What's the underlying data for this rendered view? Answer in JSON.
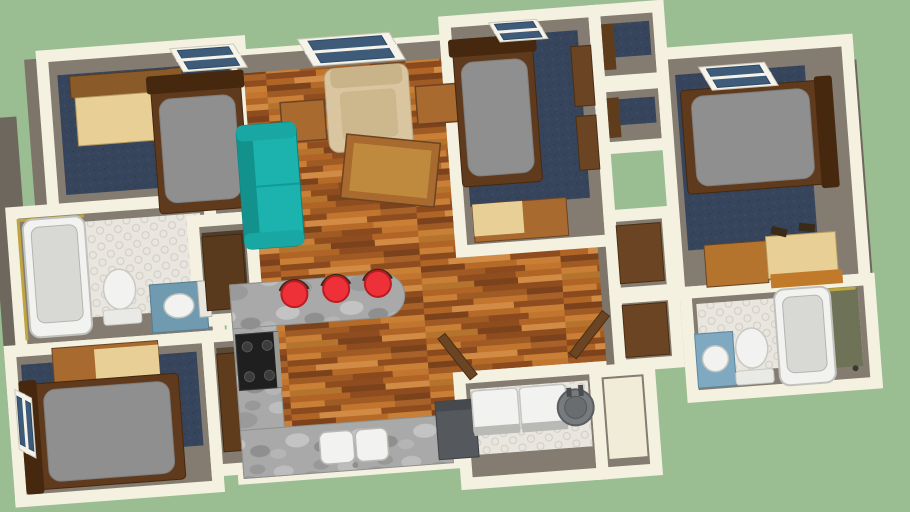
{
  "meta": {
    "application": "3d-floor-plan-viewer",
    "description": "Top-down 3D rendered floor plan of an apartment on a green viewport background",
    "visible_text": []
  },
  "canvas": {
    "width": 910,
    "height": 512,
    "background": "#9abd92",
    "rotation_deg": -4.3,
    "rotation_center": [
      455,
      256
    ]
  },
  "palette": {
    "bg": "#9abd92",
    "wall": "#f4f1e1",
    "face": "#847c70",
    "faceMid": "#7d7569",
    "faceDark": "#6e675d",
    "carpet": "#36455c",
    "teal": "#1cb3ae",
    "tealDark": "#12918d",
    "beige": "#d9c6a0",
    "beigeDark": "#c9b489",
    "red": "#ee3038",
    "white": "#f2f2f0",
    "whiteDim": "#d8d8d4",
    "steel": "#55585c",
    "woodFurn": "#a86a2e",
    "woodLight": "#e8cf96",
    "woodMid": "#8a5a28",
    "frameDark": "#5f3a1d",
    "frameDarker": "#46280f",
    "doorBrown": "#6b4423",
    "mattress": "#8f8f8f",
    "glass": "#3e5c7a",
    "gold": "#bfa53f",
    "olive": "#6e7257",
    "vanityBlue": "#6f9ab0",
    "vanityBlue2": "#7fa9c0",
    "black": "#1f1f1f",
    "heater": "#787b7e",
    "heaterDark": "#5a5d60",
    "ctrl": "#b9b9b6"
  },
  "scene": [
    {
      "t": "rect",
      "name": "west-wall-face",
      "x": -2,
      "y": 84,
      "w": 30,
      "h": 380,
      "f": "faceDark"
    },
    {
      "t": "rect",
      "name": "left-jog-wall-face",
      "x": 40,
      "y": 28,
      "w": 30,
      "h": 162,
      "f": "faceMid"
    },
    {
      "t": "rect",
      "name": "right-wall-face",
      "x": 852,
      "y": 90,
      "w": 18,
      "h": 320,
      "f": "faceDark"
    },
    {
      "t": "room",
      "name": "bedroom-top-left",
      "x": 58,
      "y": 26,
      "w": 198,
      "h": 176,
      "floor": "carpet",
      "in": [
        20,
        12,
        36,
        14
      ]
    },
    {
      "t": "path",
      "name": "main-wood-floor",
      "d": "M252,40 L462,40 L462,230 L612,230 L612,378 L462,378 L462,462 L228,462 L228,268 L252,268 Z",
      "f": "wood",
      "s": "wall",
      "sw": 12
    },
    {
      "t": "rect",
      "name": "living-north-wall-face",
      "x": 252,
      "y": 40,
      "w": 210,
      "h": 18,
      "f": "face"
    },
    {
      "t": "rect",
      "name": "hall-east-wall-face",
      "x": 598,
      "y": 230,
      "w": 14,
      "h": 148,
      "f": "faceMid"
    },
    {
      "t": "room",
      "name": "bedroom-middle",
      "x": 462,
      "y": 22,
      "w": 150,
      "h": 230,
      "floor": "carpet",
      "in": [
        18,
        18,
        44,
        12
      ]
    },
    {
      "t": "room",
      "name": "closet-a",
      "x": 612,
      "y": 22,
      "w": 64,
      "h": 72,
      "floor": "carpet",
      "in": [
        14,
        10,
        24,
        8
      ]
    },
    {
      "t": "room",
      "name": "closet-b",
      "x": 612,
      "y": 98,
      "w": 64,
      "h": 62,
      "floor": "carpet",
      "in": [
        14,
        10,
        22,
        8
      ]
    },
    {
      "t": "room",
      "name": "bedroom-right",
      "x": 676,
      "y": 70,
      "w": 186,
      "h": 240,
      "floor": "carpet",
      "in": [
        22,
        44,
        42,
        12
      ]
    },
    {
      "t": "room",
      "name": "bathroom-left",
      "x": 16,
      "y": 180,
      "w": 198,
      "h": 138,
      "floor": "hex",
      "in": [
        14,
        10,
        28,
        10
      ]
    },
    {
      "t": "room",
      "name": "pantry",
      "x": 196,
      "y": 202,
      "w": 58,
      "h": 100,
      "floor": "#4e3d2c",
      "in": [
        12,
        8,
        20,
        8
      ]
    },
    {
      "t": "room",
      "name": "bedroom-bottom-left",
      "x": 4,
      "y": 318,
      "w": 198,
      "h": 150,
      "floor": "carpet",
      "in": [
        14,
        12,
        42,
        10
      ]
    },
    {
      "t": "room",
      "name": "closet-bottom",
      "x": 202,
      "y": 318,
      "w": 54,
      "h": 134,
      "floor": "#5a4936",
      "in": [
        12,
        8,
        28,
        8
      ]
    },
    {
      "t": "room",
      "name": "hall-closet-a",
      "x": 612,
      "y": 228,
      "w": 58,
      "h": 78,
      "floor": "faceMid",
      "in": [
        10,
        8,
        16,
        8
      ]
    },
    {
      "t": "room",
      "name": "hall-closet-b",
      "x": 612,
      "y": 310,
      "w": 58,
      "h": 68,
      "floor": "faceMid",
      "in": [
        10,
        8,
        16,
        8
      ]
    },
    {
      "t": "room",
      "name": "bathroom-right",
      "x": 682,
      "y": 310,
      "w": 184,
      "h": 104,
      "floor": "hex",
      "in": [
        12,
        12,
        22,
        10
      ]
    },
    {
      "t": "room",
      "name": "laundry-room",
      "x": 450,
      "y": 378,
      "w": 136,
      "h": 106,
      "floor": "hex",
      "in": [
        12,
        8,
        28,
        10
      ]
    },
    {
      "t": "room",
      "name": "utility-extension",
      "x": 586,
      "y": 382,
      "w": 54,
      "h": 102,
      "floor": "#f0ecd8",
      "in": [
        8,
        8,
        14,
        8
      ]
    },
    {
      "t": "rect",
      "name": "desk-hutch",
      "x": 84,
      "y": 48,
      "w": 110,
      "h": 22,
      "f": "woodMid",
      "s": "frameDark",
      "sw": 1
    },
    {
      "t": "rect",
      "name": "desk-surface",
      "x": 88,
      "y": 70,
      "w": 104,
      "h": 48,
      "f": "woodLight",
      "s": "#b99a5e",
      "sw": 1
    },
    {
      "t": "rect",
      "name": "desk-side-panel",
      "x": 182,
      "y": 48,
      "w": 14,
      "h": 70,
      "f": "woodMid"
    },
    {
      "t": "bed",
      "name": "bed-top-left",
      "x": 164,
      "y": 62,
      "w": 90,
      "h": 130,
      "head": "top"
    },
    {
      "t": "rect",
      "name": "armchair",
      "x": 338,
      "y": 60,
      "w": 84,
      "h": 84,
      "rx": 10,
      "f": "beige",
      "s": "#b8a57e",
      "sw": 1
    },
    {
      "t": "rect",
      "name": "armchair-back",
      "x": 344,
      "y": 60,
      "w": 72,
      "h": 20,
      "rx": 6,
      "f": "beigeDark"
    },
    {
      "t": "rect",
      "name": "armchair-seat",
      "x": 352,
      "y": 84,
      "w": 56,
      "h": 48,
      "rx": 5,
      "f": "#cdb78d"
    },
    {
      "t": "rect",
      "name": "end-table-left",
      "x": 292,
      "y": 90,
      "w": 44,
      "h": 40,
      "f": "woodFurn",
      "s": "#6b4423",
      "sw": 1.5
    },
    {
      "t": "rect",
      "name": "end-table-right",
      "x": 428,
      "y": 84,
      "w": 42,
      "h": 38,
      "f": "woodFurn",
      "s": "#6b4423",
      "sw": 1.5
    },
    {
      "t": "rect",
      "name": "coffee-table",
      "x": 350,
      "y": 134,
      "w": 94,
      "h": 64,
      "rot": 10,
      "f": "woodFurn",
      "s": "#6b4423",
      "sw": 1.5
    },
    {
      "t": "rect",
      "name": "coffee-table-top",
      "x": 358,
      "y": 142,
      "w": 78,
      "h": 48,
      "rot": 10,
      "f": "#c08a3e"
    },
    {
      "t": "rect",
      "name": "sofa",
      "x": 246,
      "y": 110,
      "w": 60,
      "h": 124,
      "rx": 8,
      "f": "teal",
      "s": "#0e7f7c",
      "sw": 1
    },
    {
      "t": "rect",
      "name": "sofa-back",
      "x": 246,
      "y": 110,
      "w": 16,
      "h": 124,
      "rx": 6,
      "f": "tealDark"
    },
    {
      "t": "rect",
      "name": "sofa-arm",
      "x": 246,
      "y": 110,
      "w": 60,
      "h": 16,
      "rx": 6,
      "f": "#18a7a2"
    },
    {
      "t": "rect",
      "name": "sofa-arm",
      "x": 246,
      "y": 218,
      "w": 60,
      "h": 16,
      "rx": 6,
      "f": "#18a7a2"
    },
    {
      "t": "line",
      "name": "sofa-cushion-seam",
      "x1": 262,
      "y1": 172,
      "x2": 306,
      "y2": 172,
      "s": "#129a96",
      "sw": 2
    },
    {
      "t": "bed",
      "name": "bed-middle",
      "x": 468,
      "y": 48,
      "w": 80,
      "h": 140,
      "head": "top"
    },
    {
      "t": "rect",
      "name": "closet-door",
      "x": 586,
      "y": 56,
      "w": 20,
      "h": 60,
      "f": "doorBrown",
      "s": "#4a2f12",
      "sw": 1
    },
    {
      "t": "rect",
      "name": "closet-door",
      "x": 586,
      "y": 126,
      "w": 20,
      "h": 54,
      "f": "doorBrown",
      "s": "#4a2f12",
      "sw": 1
    },
    {
      "t": "rect",
      "name": "desk",
      "x": 476,
      "y": 206,
      "w": 94,
      "h": 38,
      "f": "woodFurn",
      "s": "#6b4423",
      "sw": 1
    },
    {
      "t": "rect",
      "name": "desk-top",
      "x": 476,
      "y": 206,
      "w": 50,
      "h": 32,
      "f": "woodLight"
    },
    {
      "t": "rect",
      "name": "closet-door",
      "x": 618,
      "y": 36,
      "w": 12,
      "h": 46,
      "f": "#5f3c1c"
    },
    {
      "t": "rect",
      "name": "closet-door",
      "x": 618,
      "y": 110,
      "w": 12,
      "h": 40,
      "f": "#5f3c1c"
    },
    {
      "t": "bed",
      "name": "bed-right",
      "x": 692,
      "y": 108,
      "w": 144,
      "h": 104,
      "head": "right"
    },
    {
      "t": "rect",
      "name": "desk",
      "x": 704,
      "y": 264,
      "w": 62,
      "h": 42,
      "f": "#b5742e",
      "s": "#6b4423",
      "sw": 1
    },
    {
      "t": "rect",
      "name": "desk-top",
      "x": 766,
      "y": 260,
      "w": 70,
      "h": 42,
      "f": "woodLight",
      "s": "#b99a5e",
      "sw": 1
    },
    {
      "t": "rect",
      "name": "desk-shelf",
      "x": 768,
      "y": 298,
      "w": 72,
      "h": 14,
      "f": "#c07a2a"
    },
    {
      "t": "rect",
      "name": "shoe",
      "x": 772,
      "y": 252,
      "w": 16,
      "h": 8,
      "rot": 18,
      "f": "#3a2a18"
    },
    {
      "t": "rect",
      "name": "shoe",
      "x": 800,
      "y": 250,
      "w": 16,
      "h": 8,
      "rot": 10,
      "f": "#3a2a18"
    },
    {
      "t": "path",
      "name": "shower-trim",
      "d": "M22,308 L22,188 L88,188",
      "f": "none",
      "s": "gold",
      "sw": 3
    },
    {
      "t": "rect",
      "name": "bathtub",
      "x": 26,
      "y": 188,
      "w": 62,
      "h": 118,
      "rx": 10,
      "f": "white",
      "s": "#c2c2bd",
      "sw": 2
    },
    {
      "t": "rect",
      "name": "bathtub-inner",
      "x": 34,
      "y": 196,
      "w": 46,
      "h": 96,
      "rx": 8,
      "f": "whiteDim",
      "s": "#b5b5b0",
      "sw": 1
    },
    {
      "t": "ellipse",
      "name": "toilet-bowl",
      "cx": 118,
      "cy": 264,
      "rx": 16,
      "ry": 20,
      "f": "white",
      "s": "#c9c9c4",
      "sw": 1.5
    },
    {
      "t": "rect",
      "name": "toilet-tank",
      "x": 100,
      "y": 284,
      "w": 38,
      "h": 15,
      "rx": 3,
      "f": "#e9e9e6",
      "s": "#c9c9c4",
      "sw": 1
    },
    {
      "t": "rect",
      "name": "bathroom-vanity",
      "x": 148,
      "y": 262,
      "w": 56,
      "h": 48,
      "f": "vanityBlue",
      "s": "#557e92",
      "sw": 1
    },
    {
      "t": "ellipse",
      "name": "sink",
      "cx": 176,
      "cy": 285,
      "rx": 15,
      "ry": 12,
      "f": "white",
      "s": "#c2c2bd",
      "sw": 1.5
    },
    {
      "t": "rect",
      "name": "mirror",
      "x": 196,
      "y": 262,
      "w": 12,
      "h": 36,
      "f": "#e8e6de",
      "s": "#b5b3a8",
      "sw": 1
    },
    {
      "t": "rect",
      "name": "desk",
      "x": 46,
      "y": 318,
      "w": 106,
      "h": 38,
      "f": "woodFurn",
      "s": "#6b4423",
      "sw": 1
    },
    {
      "t": "rect",
      "name": "desk-top",
      "x": 88,
      "y": 322,
      "w": 64,
      "h": 32,
      "f": "woodLight"
    },
    {
      "t": "rect",
      "name": "desk-chair",
      "x": 96,
      "y": 352,
      "w": 34,
      "h": 14,
      "f": "#b5742e"
    },
    {
      "t": "bed",
      "name": "bed-bottom-left",
      "x": 18,
      "y": 352,
      "w": 152,
      "h": 106,
      "head": "left"
    },
    {
      "t": "rect",
      "name": "closet-door",
      "x": 210,
      "y": 336,
      "w": 38,
      "h": 98,
      "f": "#5f3c1c",
      "s": "#3e2812",
      "sw": 1
    },
    {
      "t": "rect",
      "name": "pantry-door",
      "x": 204,
      "y": 218,
      "w": 40,
      "h": 74,
      "f": "#5a3a1c",
      "s": "#3e2812",
      "sw": 1
    },
    {
      "t": "rect",
      "name": "kitchen-counter-left",
      "x": 228,
      "y": 268,
      "w": 44,
      "h": 194,
      "f": "marble",
      "s": "#8f8f8a",
      "sw": 1
    },
    {
      "t": "path",
      "name": "kitchen-counter-peninsula",
      "d": "M228,268 L380,268 A22,22 0 0 1 380,312 L228,312 Z",
      "f": "marble",
      "s": "#8f8f8a",
      "sw": 1
    },
    {
      "t": "rect",
      "name": "kitchen-counter-bottom",
      "x": 228,
      "y": 414,
      "w": 210,
      "h": 48,
      "f": "marble",
      "s": "#8f8f8a",
      "sw": 1
    },
    {
      "t": "rect",
      "name": "stove",
      "x": 230,
      "y": 318,
      "w": 42,
      "h": 56,
      "f": "black",
      "s": "#3a3a3a",
      "sw": 1
    },
    {
      "t": "circle",
      "name": "burner",
      "cx": 241,
      "cy": 331,
      "r": 5,
      "f": "#3c3c3c",
      "s": "#565656",
      "sw": 1
    },
    {
      "t": "circle",
      "name": "burner",
      "cx": 261,
      "cy": 331,
      "r": 5,
      "f": "#3c3c3c",
      "s": "#565656",
      "sw": 1
    },
    {
      "t": "circle",
      "name": "burner",
      "cx": 241,
      "cy": 361,
      "r": 5,
      "f": "#3c3c3c",
      "s": "#565656",
      "sw": 1
    },
    {
      "t": "circle",
      "name": "burner",
      "cx": 261,
      "cy": 361,
      "r": 5,
      "f": "#3c3c3c",
      "s": "#565656",
      "sw": 1
    },
    {
      "t": "rect",
      "name": "stove-trim",
      "x": 268,
      "y": 318,
      "w": 5,
      "h": 56,
      "f": "#9a9a95"
    },
    {
      "t": "rect",
      "name": "sink-basin",
      "x": 306,
      "y": 422,
      "w": 34,
      "h": 32,
      "rx": 7,
      "f": "white",
      "s": "#b9b9b4",
      "sw": 1.5
    },
    {
      "t": "rect",
      "name": "sink-basin",
      "x": 342,
      "y": 422,
      "w": 32,
      "h": 32,
      "rx": 7,
      "f": "white",
      "s": "#b9b9b4",
      "sw": 1.5
    },
    {
      "t": "circle",
      "name": "faucet",
      "cx": 340,
      "cy": 457,
      "r": 3,
      "f": "#8f8f8a"
    },
    {
      "t": "rect",
      "name": "appliance-counter",
      "x": 424,
      "y": 400,
      "w": 40,
      "h": 58,
      "f": "steel",
      "s": "#3e4144",
      "sw": 1
    },
    {
      "t": "rect",
      "name": "appliance-counter-top",
      "x": 424,
      "y": 400,
      "w": 40,
      "h": 10,
      "f": "#464a4e"
    },
    {
      "t": "stool",
      "name": "bar-stool",
      "cx": 292,
      "cy": 282
    },
    {
      "t": "stool",
      "name": "bar-stool",
      "cx": 334,
      "cy": 280
    },
    {
      "t": "stool",
      "name": "bar-stool",
      "cx": 376,
      "cy": 278
    },
    {
      "t": "rect",
      "name": "closet-door",
      "x": 618,
      "y": 238,
      "w": 44,
      "h": 58,
      "f": "doorBrown",
      "s": "#4a2f12",
      "sw": 1
    },
    {
      "t": "rect",
      "name": "closet-door",
      "x": 618,
      "y": 318,
      "w": 44,
      "h": 52,
      "f": "doorBrown",
      "s": "#4a2f12",
      "sw": 1
    },
    {
      "t": "rect",
      "name": "shower-floor",
      "x": 824,
      "y": 318,
      "w": 30,
      "h": 78,
      "f": "olive"
    },
    {
      "t": "path",
      "name": "shower-trim",
      "d": "M824,396 L824,318 L852,318",
      "f": "none",
      "s": "gold",
      "sw": 3
    },
    {
      "t": "rect",
      "name": "bathroom-vanity",
      "x": 688,
      "y": 352,
      "w": 38,
      "h": 54,
      "f": "vanityBlue2",
      "s": "#5d87a0",
      "sw": 1
    },
    {
      "t": "circle",
      "name": "sink",
      "cx": 707,
      "cy": 378,
      "r": 13,
      "f": "white",
      "s": "#c2c2bd",
      "sw": 1.5
    },
    {
      "t": "ellipse",
      "name": "toilet-bowl",
      "cx": 744,
      "cy": 370,
      "rx": 16,
      "ry": 20,
      "f": "white",
      "s": "#c9c9c4",
      "sw": 1.5
    },
    {
      "t": "rect",
      "name": "toilet-tank",
      "x": 726,
      "y": 392,
      "w": 38,
      "h": 14,
      "rx": 3,
      "f": "#e9e9e6",
      "s": "#c9c9c4",
      "sw": 1
    },
    {
      "t": "rect",
      "name": "bathtub",
      "x": 770,
      "y": 314,
      "w": 56,
      "h": 96,
      "rx": 10,
      "f": "white",
      "s": "#c2c2bd",
      "sw": 2
    },
    {
      "t": "rect",
      "name": "bathtub-inner",
      "x": 778,
      "y": 322,
      "w": 40,
      "h": 76,
      "rx": 8,
      "f": "whiteDim",
      "s": "#b5b5b0",
      "sw": 1
    },
    {
      "t": "circle",
      "name": "tub-faucet",
      "cx": 846,
      "cy": 398,
      "r": 3,
      "f": "#3a3a33"
    },
    {
      "t": "rect",
      "name": "washer",
      "x": 461,
      "y": 392,
      "w": 46,
      "h": 44,
      "rx": 4,
      "f": "white",
      "s": "#c6c6c2",
      "sw": 1.5
    },
    {
      "t": "rect",
      "name": "washer-panel",
      "x": 461,
      "y": 428,
      "w": 46,
      "h": 9,
      "f": "ctrl"
    },
    {
      "t": "rect",
      "name": "dryer",
      "x": 509,
      "y": 392,
      "w": 46,
      "h": 44,
      "rx": 4,
      "f": "white",
      "s": "#c6c6c2",
      "sw": 1.5
    },
    {
      "t": "rect",
      "name": "dryer-panel",
      "x": 509,
      "y": 428,
      "w": 46,
      "h": 9,
      "f": "ctrl"
    },
    {
      "t": "circle",
      "name": "water-heater",
      "cx": 564,
      "cy": 416,
      "r": 18,
      "f": "heater",
      "s": "heaterDark",
      "sw": 2
    },
    {
      "t": "circle",
      "name": "water-heater-top",
      "cx": 564,
      "cy": 416,
      "r": 11,
      "f": "#6a6d70",
      "s": "#53565a",
      "sw": 1
    },
    {
      "t": "rect",
      "name": "heater-pipe",
      "x": 556,
      "y": 396,
      "w": 5,
      "h": 9,
      "f": "#4a4d50"
    },
    {
      "t": "rect",
      "name": "heater-pipe",
      "x": 568,
      "y": 394,
      "w": 5,
      "h": 11,
      "f": "#4a4d50"
    },
    {
      "t": "rect",
      "name": "open-door",
      "x": 424,
      "y": 352,
      "w": 52,
      "h": 9,
      "rot": 56,
      "f": "doorBrown",
      "s": "#4a2f12",
      "sw": 1
    },
    {
      "t": "rect",
      "name": "open-door",
      "x": 556,
      "y": 340,
      "w": 54,
      "h": 9,
      "rot": -48,
      "f": "doorBrown",
      "s": "#4a2f12",
      "sw": 1
    },
    {
      "t": "window",
      "name": "window-bedroom-top-left",
      "x": 186,
      "y": 28,
      "len": 64,
      "dep": 24,
      "sk": 12,
      "dir": "h"
    },
    {
      "t": "window",
      "name": "window-living-room",
      "x": 314,
      "y": 28,
      "len": 92,
      "dep": 28,
      "sk": 14,
      "dir": "h"
    },
    {
      "t": "window",
      "name": "window-bedroom-middle",
      "x": 506,
      "y": 26,
      "len": 48,
      "dep": 20,
      "sk": 10,
      "dir": "h"
    },
    {
      "t": "window",
      "name": "window-bedroom-right",
      "x": 712,
      "y": 86,
      "len": 66,
      "dep": 24,
      "sk": 12,
      "dir": "h"
    },
    {
      "t": "window",
      "name": "window-bedroom-bottom-left",
      "x": 6,
      "y": 356,
      "len": 60,
      "dep": 16,
      "sk": 10,
      "dir": "v"
    }
  ]
}
